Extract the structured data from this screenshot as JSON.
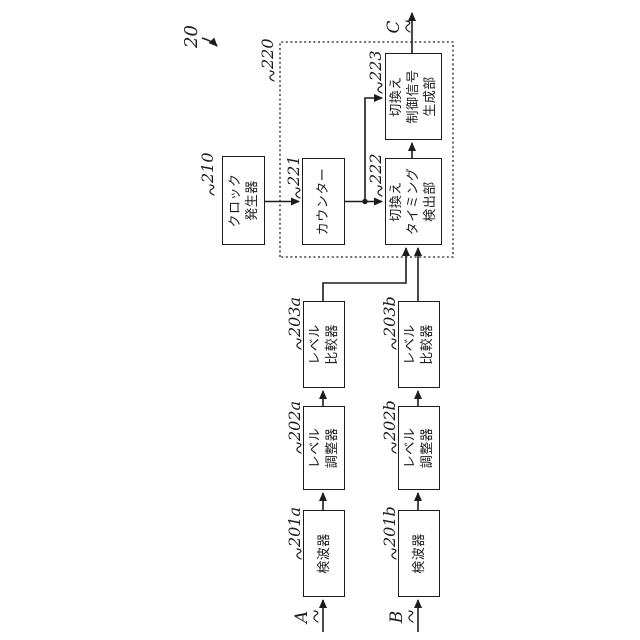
{
  "figure": {
    "ref": "20",
    "unit_ref": "220"
  },
  "ports": {
    "input_a": "A",
    "input_b": "B",
    "output_c": "C"
  },
  "blocks": {
    "clock": {
      "ref": "210",
      "label": "クロック\n発生器"
    },
    "counter": {
      "ref": "221",
      "label": "カウンター"
    },
    "timing": {
      "ref": "222",
      "label": "切換え\nタイミング\n検出部"
    },
    "siggen": {
      "ref": "223",
      "label": "切換え\n制御信号\n生成部"
    },
    "det_a": {
      "ref": "201a",
      "label": "検波器"
    },
    "adj_a": {
      "ref": "202a",
      "label": "レベル\n調整器"
    },
    "cmp_a": {
      "ref": "203a",
      "label": "レベル\n比較器"
    },
    "det_b": {
      "ref": "201b",
      "label": "検波器"
    },
    "adj_b": {
      "ref": "202b",
      "label": "レベル\n調整器"
    },
    "cmp_b": {
      "ref": "203b",
      "label": "レベル\n比較器"
    }
  },
  "colors": {
    "ink": "#1c1c1c",
    "background": "#ffffff"
  }
}
